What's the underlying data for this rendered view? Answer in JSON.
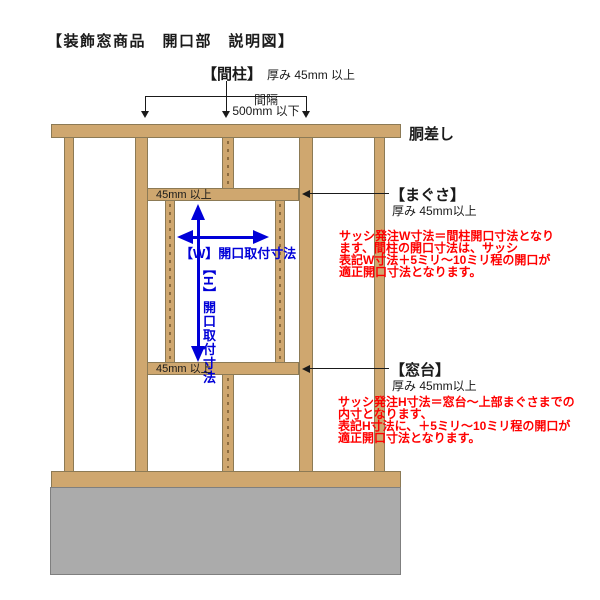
{
  "title": "【装飾窓商品　開口部　説明図】",
  "labels": {
    "mabashira": "【間柱】",
    "mabashira_spec": "厚み 45mm 以上",
    "spacing_line1": "間隔",
    "spacing_line2": "500mm 以下",
    "dousashi": "胴差し",
    "magusa": "【まぐさ】",
    "magusa_spec": "厚み 45mm以上",
    "madodai": "【窓台】",
    "madodai_spec": "厚み 45mm以上",
    "lintel_min_thickness": "45mm 以上",
    "sill_min_thickness": "45mm 以上",
    "w_dimension": "【W】開口取付寸法",
    "h_dimension": "【H】開口取付寸法"
  },
  "notes": {
    "w_note": [
      "サッシ発注W寸法＝間柱開口寸法となり",
      "ます、間柱の開口寸法は、サッシ",
      "表記W寸法＋5ミリ～10ミリ程の開口が",
      "適正開口寸法となります。"
    ],
    "h_note": [
      "サッシ発注H寸法＝窓台～上部まぐさまでの",
      "内寸となります、",
      "表記H寸法に、＋5ミリ～10ミリ程の開口が",
      "適正開口寸法となります。"
    ]
  },
  "colors": {
    "wood": "#cfa76f",
    "wood_outline": "#8c7a55",
    "foundation_gray": "#ababab",
    "dimension_blue": "#0000d8",
    "note_red": "#ff0000",
    "text_black": "#1a1a1a",
    "background": "#ffffff"
  }
}
